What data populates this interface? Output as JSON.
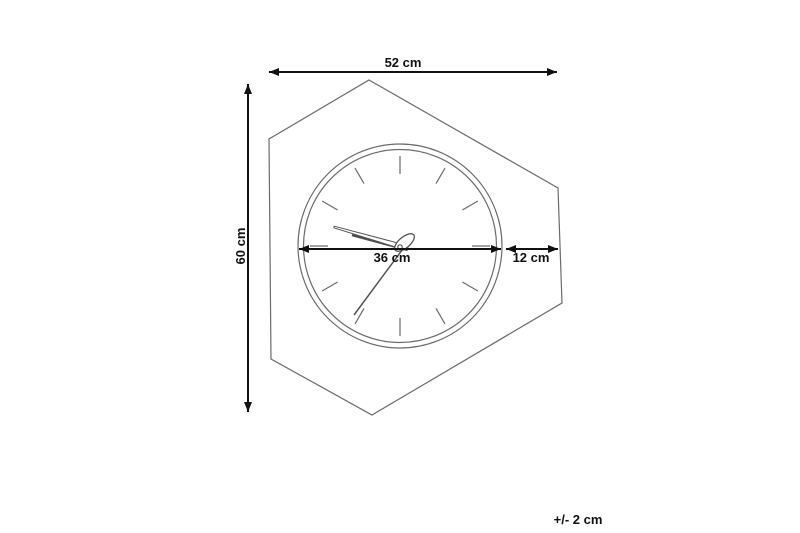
{
  "diagram": {
    "type": "product-dimension-drawing",
    "subject": "hexagonal-wall-clock",
    "dimensions": {
      "width": {
        "label": "52 cm"
      },
      "height": {
        "label": "60 cm"
      },
      "dial_diameter": {
        "label": "36 cm"
      },
      "side_section": {
        "label": "12 cm"
      },
      "tolerance": {
        "label": "+/- 2 cm"
      }
    },
    "colors": {
      "background": "#ffffff",
      "outline": "#6b6b6b",
      "hands": "#4f4f4f",
      "dimension_lines": "#111111"
    }
  }
}
